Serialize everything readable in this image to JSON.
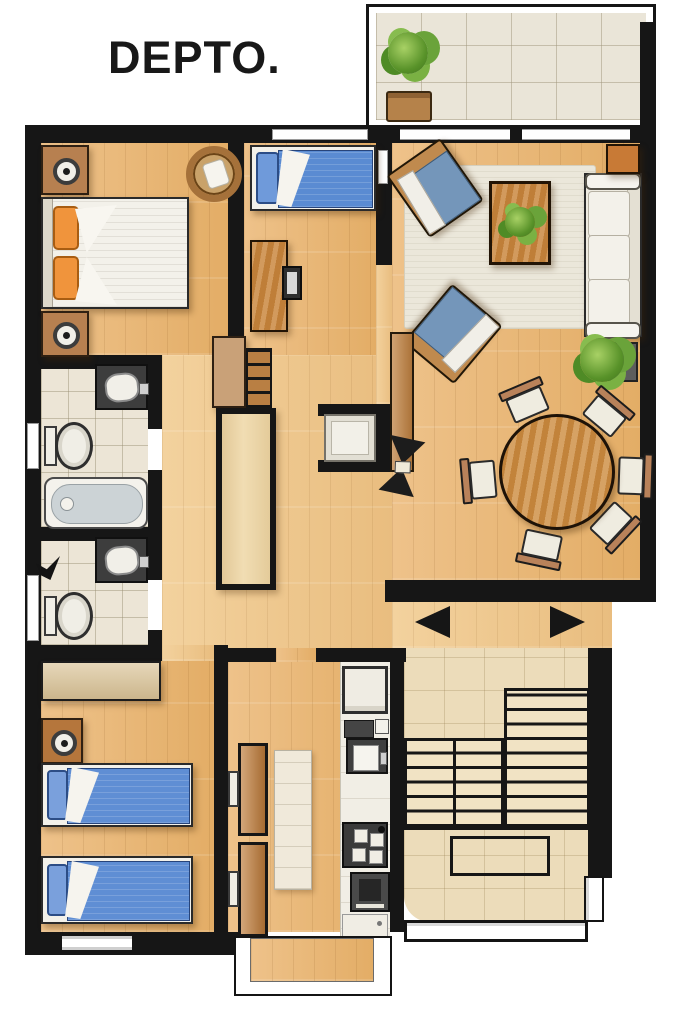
{
  "title": "DEPTO.",
  "colors": {
    "wall": "#161616",
    "wood_floor": "#e9bc7e",
    "hall_floor": "#f0cd97",
    "bath_tile": "#ece5d6",
    "terrace_tile": "#eae5d8",
    "stair_floor": "#ecdcba",
    "bed_blue": "#5a8bd2",
    "cushion_blue": "#7496ba",
    "pillow_orange": "#f0943c",
    "furniture_wood": "#c9873e",
    "white_upholstery": "#f3f1ea",
    "plant_green": "#6aa33a",
    "appliance_dark": "#3b3b3b"
  },
  "rooms": [
    "terrace",
    "living-room",
    "dining-area",
    "master-bedroom",
    "bedroom-2",
    "bedroom-3",
    "bathroom-1",
    "bathroom-2",
    "hallway",
    "kitchen",
    "stairs",
    "entry"
  ],
  "furniture": {
    "terrace": [
      "potted-plant",
      "tiled-floor"
    ],
    "master_bedroom": [
      "double-bed",
      "orange-pillows",
      "nightstand-with-lamp",
      "nightstand-with-lamp",
      "round-pouf"
    ],
    "bedroom_2": [
      "single-bed-blue",
      "desk",
      "monitor"
    ],
    "living_room": [
      "rug",
      "coffee-table-with-plant",
      "sofa-white",
      "armchair-blue",
      "armchair-blue",
      "side-table",
      "floor-plant",
      "console-shelf",
      "decor-fan"
    ],
    "dining_area": [
      "round-table",
      "chair",
      "chair",
      "chair",
      "chair",
      "chair",
      "chair"
    ],
    "hallway": [
      "sideboard",
      "slatted-rack",
      "built-in-closet",
      "alcove-seat"
    ],
    "bathroom_1": [
      "vanity-sink",
      "toilet",
      "bathtub"
    ],
    "bathroom_2": [
      "vanity-sink",
      "toilet"
    ],
    "bedroom_3": [
      "desk",
      "nightstand-with-lamp",
      "single-bed-blue",
      "single-bed-blue"
    ],
    "kitchen": [
      "wardrobe",
      "island-counter",
      "fridge",
      "sink",
      "cooktop",
      "oven",
      "base-cabinet"
    ],
    "stairs": [
      "upper-flight",
      "lower-flights",
      "landing",
      "railing",
      "gate"
    ],
    "entry": [
      "direction-arrow-left",
      "direction-arrow-right"
    ]
  }
}
